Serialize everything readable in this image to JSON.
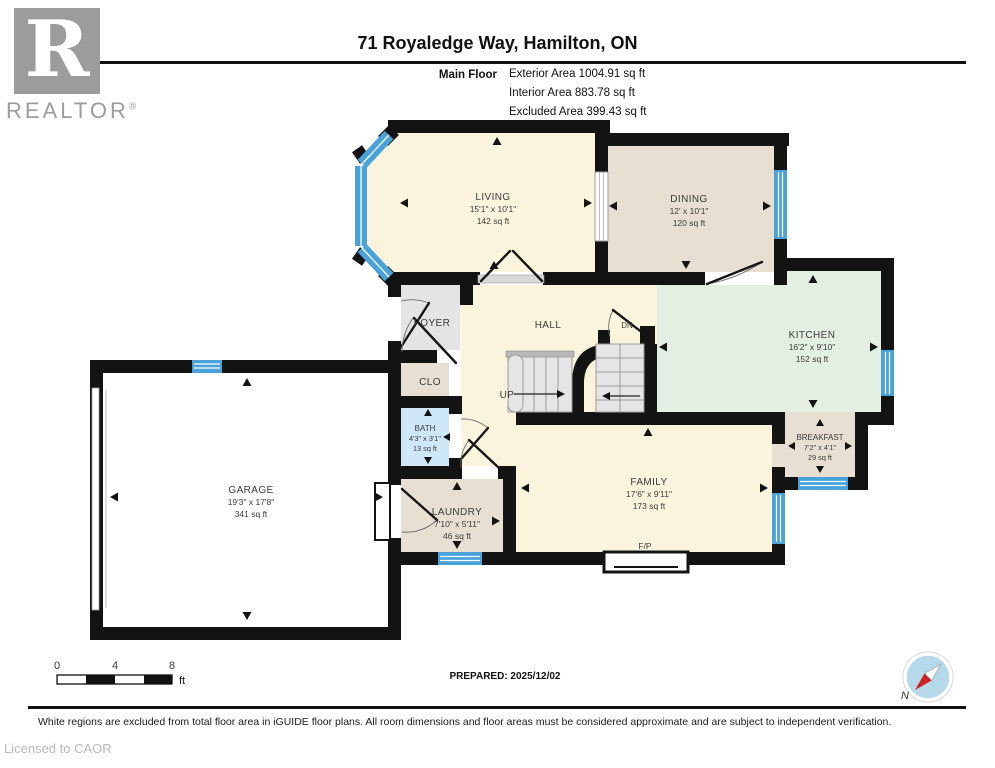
{
  "header": {
    "title": "71 Royaledge Way, Hamilton, ON",
    "floor_label": "Main Floor",
    "areas": [
      "Exterior Area 1004.91 sq ft",
      "Interior Area 883.78 sq ft",
      "Excluded Area 399.43 sq ft"
    ],
    "logo": {
      "letter": "R",
      "brand": "REALTOR",
      "reg": "®"
    }
  },
  "rooms": {
    "living": {
      "name": "LIVING",
      "dims": "15'1\" x 10'1\"",
      "area": "142 sq ft"
    },
    "dining": {
      "name": "DINING",
      "dims": "12' x 10'1\"",
      "area": "120 sq ft"
    },
    "kitchen": {
      "name": "KITCHEN",
      "dims": "16'2\" x 9'10\"",
      "area": "152 sq ft"
    },
    "breakfast": {
      "name": "BREAKFAST",
      "dims": "7'2\" x 4'1\"",
      "area": "29 sq ft"
    },
    "family": {
      "name": "FAMILY",
      "dims": "17'6\" x 9'11\"",
      "area": "173 sq ft"
    },
    "laundry": {
      "name": "LAUNDRY",
      "dims": "7'10\" x 5'11\"",
      "area": "46 sq ft"
    },
    "garage": {
      "name": "GARAGE",
      "dims": "19'3\" x 17'8\"",
      "area": "341 sq ft"
    },
    "bath": {
      "name": "BATH",
      "dims": "4'3\" x 3'1\"",
      "area": "13 sq ft"
    },
    "foyer": {
      "name": "FOYER"
    },
    "hall": {
      "name": "HALL"
    },
    "closet": {
      "name": "CLO"
    }
  },
  "annotations": {
    "up": "UP",
    "down": "DN",
    "fireplace": "F/P"
  },
  "scale_bar": {
    "ticks": [
      "0",
      "4",
      "8"
    ],
    "unit": "ft"
  },
  "compass": {
    "label": "N"
  },
  "footer": {
    "prepared": "PREPARED: 2025/12/02",
    "disclaimer": "White regions are excluded from total floor area in iGUIDE floor plans. All room dimensions and floor areas must be considered approximate and are subject to independent verification.",
    "license": "Licensed to CAOR"
  },
  "colors": {
    "wall": "#131313",
    "window": "#4aa3d8",
    "room_cream": "#fbf4dd",
    "room_tan": "#e7dfd1",
    "room_green": "#e3efe2",
    "room_blue": "#cfe8f8",
    "room_gray": "#e4e4e4",
    "logo_gray": "#9c9c9c",
    "compass_blue": "#b5d8ea",
    "compass_red": "#cc2127"
  }
}
